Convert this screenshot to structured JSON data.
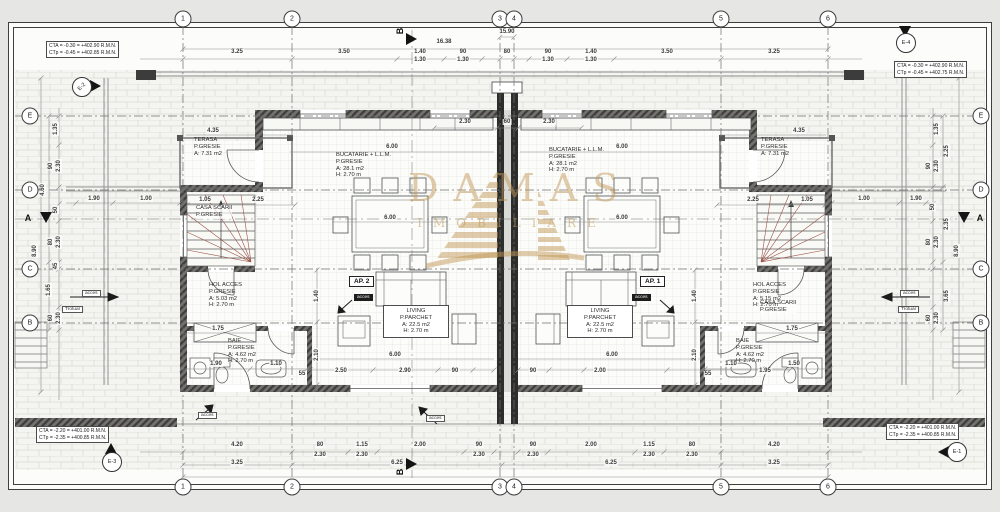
{
  "grid": {
    "cols": [
      "1",
      "2",
      "3",
      "4",
      "5",
      "6"
    ],
    "rows": [
      "E",
      "D",
      "C",
      "B"
    ],
    "section_h": "B",
    "section_v": "A"
  },
  "elevation_markers": {
    "e1": "E-1",
    "e2": "E-2",
    "e3": "E-3",
    "e4": "E-4"
  },
  "level_notes": {
    "top_left_1": "CTA = -0.30 = +402.90 R.M.N.",
    "top_left_2": "CTp = -0.45 = +402.85 R.M.N.",
    "top_right_1": "CTA = -0.30 = +402.90 R.M.N.",
    "top_right_2": "CTp = -0.45 = +402.75 R.M.N.",
    "bottom_left_1": "CTA = -2.20 = +401.00 R.M.N.",
    "bottom_left_2": "CTp = -2.35 = +400.85 R.M.N.",
    "bottom_right_1": "CTA = -2.20 = +401.00 R.M.N.",
    "bottom_right_2": "CTp = -2.35 = +400.85 R.M.N."
  },
  "apartments": {
    "ap1": "AP. 1",
    "ap2": "AP. 2"
  },
  "rooms": {
    "terasa_left": "TERASA\nP.GRESIE\nA: 7.31 m2",
    "terasa_right": "TERASA\nP.GRESIE\nA: 7.31 m2",
    "kitchen_left": "BUCATARIE + L.L.M.\nP.GRESIE\nA: 28.1 m2\nH: 2.70 m",
    "kitchen_right": "BUCATARIE + L.L.M.\nP.GRESIE\nA: 28.1 m2\nH: 2.70 m",
    "stair_left": "CASA SCARII\nP.GRESIE",
    "stair_right": "CASA SCARII\nP.GRESIE",
    "hol_left": "HOL ACCES\nP.GRESIE\nA: 5.03 m2\nH: 2.70 m",
    "hol_right": "HOL ACCES\nP.GRESIE\nA: 5.15 m2\nH: 2.70 m",
    "baie_left": "BAIE\nP.GRESIE\nA: 4.62 m2\nH: 2.70 m",
    "baie_right": "BAIE\nP.GRESIE\nA: 4.62 m2\nH: 2.70 m",
    "living_left": "LIVING\nP.PARCHET\nA: 22.5 m2\nH: 2.70 m",
    "living_right": "LIVING\nP.PARCHET\nA: 22.5 m2\nH: 2.70 m"
  },
  "labels": {
    "acces": "acces",
    "trotuar": "Trotuar"
  },
  "watermark": {
    "name": "DAMAS",
    "tagline": "IMOBILIARE"
  },
  "colors": {
    "watermark_gold": "#c19a58",
    "wall_dark": "#3e3d3b",
    "paper": "#fcfcfb"
  },
  "dims": {
    "top": [
      "16.38",
      "15.90",
      "3.25",
      "3.50",
      "1.40",
      "1.30",
      "90",
      "1.30",
      "80",
      "90",
      "1.30",
      "1.40",
      "1.30",
      "3.50",
      "3.25"
    ],
    "bottom": [
      "4.20",
      "80",
      "2.30",
      "1.15",
      "2.30",
      "2.00",
      "90",
      "2.30",
      "90",
      "2.30",
      "2.00",
      "1.15",
      "2.30",
      "80",
      "2.30",
      "4.20",
      "3.25",
      "6.25",
      "6.25",
      "3.25"
    ],
    "left": [
      "1.35",
      "90",
      "2.30",
      "4.60",
      "50",
      "80",
      "2.30",
      "8.90",
      "45",
      "1.65",
      "60",
      "2.30",
      "1.90",
      "1.00"
    ],
    "right": [
      "1.35",
      "2.25",
      "90",
      "2.30",
      "50",
      "2.35",
      "80",
      "2.30",
      "8.90",
      "3.65",
      "60",
      "2.30",
      "1.00",
      "1.90"
    ],
    "inner": [
      "4.35",
      "4.35",
      "2.30",
      "60",
      "2.30",
      "6.00",
      "6.00",
      "6.00",
      "6.00",
      "6.00",
      "6.00",
      "1.05",
      "2.25",
      "2.25",
      "1.05",
      "1.75",
      "1.75",
      "1.40",
      "1.40",
      "2.10",
      "2.10",
      "1.90",
      "1.10",
      "1.10",
      "1.50",
      "55",
      "55",
      "2.50",
      "2.90",
      "90",
      "90",
      "2.00",
      "1.95"
    ]
  }
}
